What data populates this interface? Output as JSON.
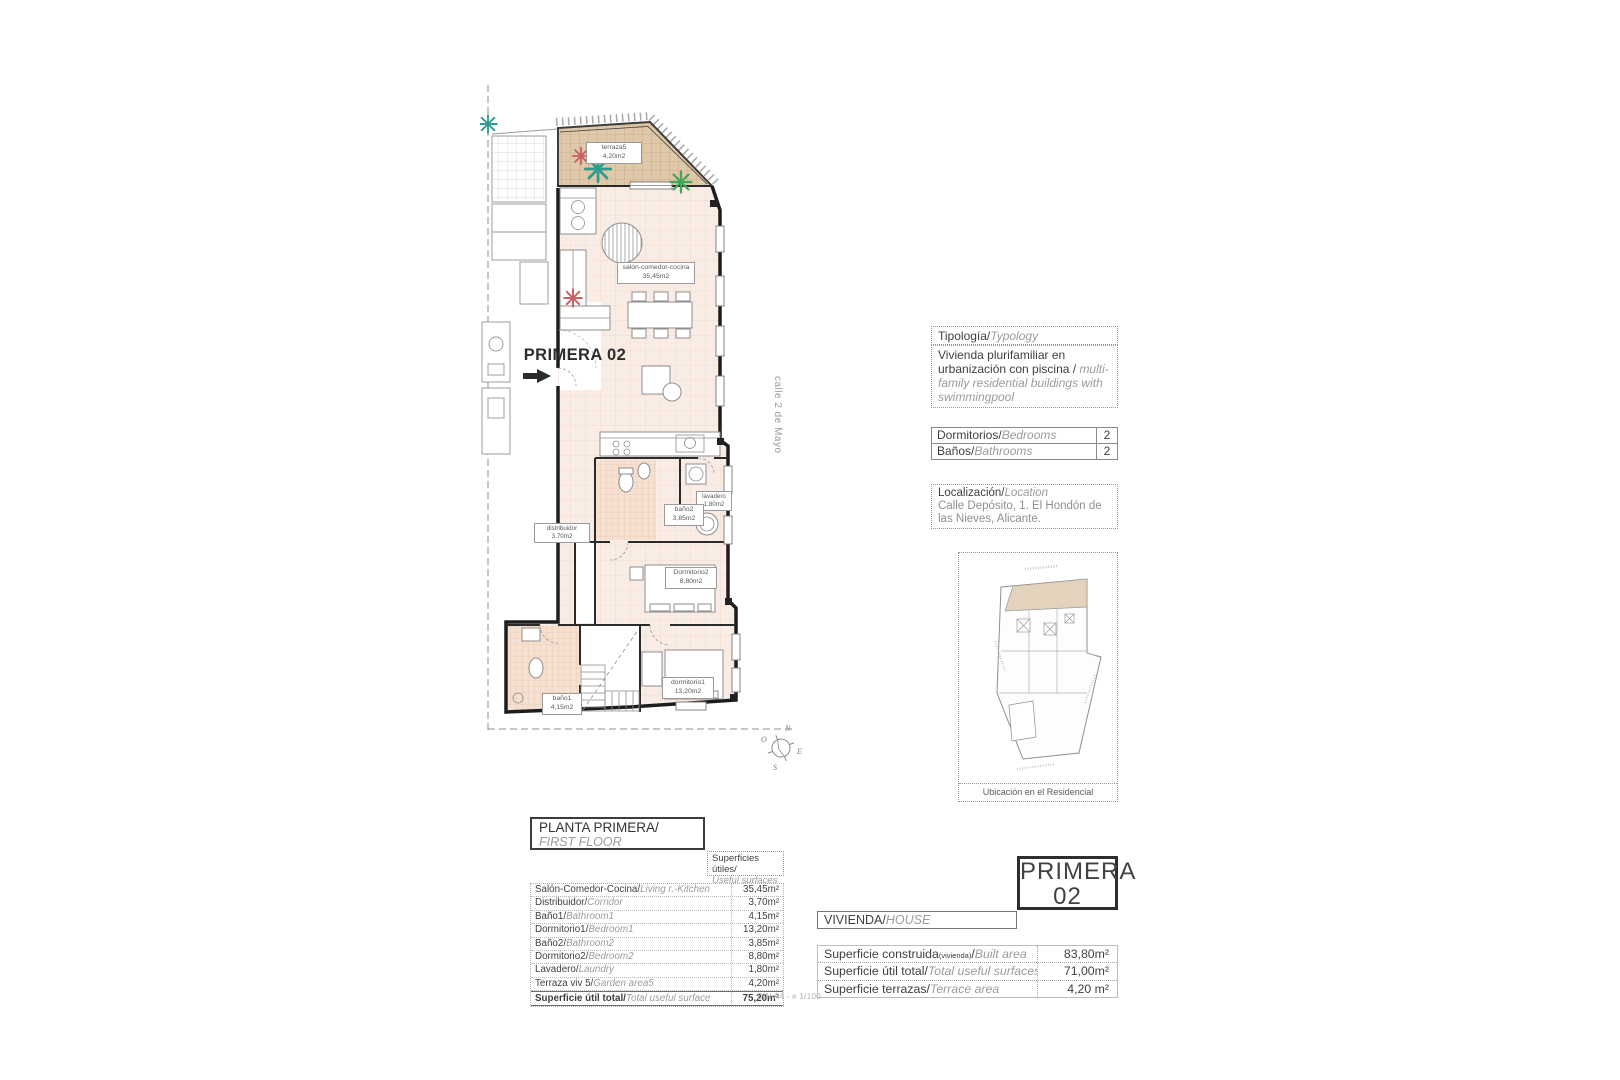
{
  "colors": {
    "floor_fill": "#f9ece4",
    "terrace_fill": "#e0c8ab",
    "bath_tile": "#f6e0d1",
    "wall": "#1d1d1d",
    "site_highlight": "#e3d2bc",
    "plant_teal": "#2f9c8e",
    "plant_green": "#44a65a",
    "plant_red": "#c95f63"
  },
  "plan": {
    "title": "PRIMERA 02",
    "street": "calle 2 de Mayo",
    "compass": {
      "n": "N",
      "e": "E",
      "s": "S",
      "o": "O"
    },
    "rooms": {
      "terraza": {
        "name": "terraza5",
        "area": "4,20m2"
      },
      "salon": {
        "name": "salón-comedor-cocina",
        "area": "35,45m2"
      },
      "lavadero": {
        "name": "lavadero",
        "area": "1,80m2"
      },
      "bano2": {
        "name": "baño2",
        "area": "3,85m2"
      },
      "distribuidor": {
        "name": "distribuidor",
        "area": "3,70m2"
      },
      "dormitorio2": {
        "name": "Dormitorio2",
        "area": "8,80m2"
      },
      "dormitorio1": {
        "name": "dormitorio1",
        "area": "13,20m2"
      },
      "bano1": {
        "name": "baño1",
        "area": "4,15m2"
      }
    }
  },
  "typology": {
    "header_es": "Tipología/",
    "header_en": "Typology",
    "body_es": "Vivienda plurifamiliar en urbanización con piscina  /",
    "body_en": "multi-family residential buildings with swimmingpool"
  },
  "counts": {
    "rows": [
      {
        "es": "Dormitorios/",
        "en": "Bedrooms",
        "value": "2"
      },
      {
        "es": "Baños/",
        "en": "Bathrooms",
        "value": "2"
      }
    ]
  },
  "location": {
    "header_es": "Localización/",
    "header_en": "Location",
    "text": "Calle Depósito, 1. El Hondón de las Nieves, Alicante."
  },
  "site": {
    "caption": "Ubicación en el Residencial"
  },
  "floor": {
    "title_es": "PLANTA PRIMERA/",
    "title_en": "FIRST FLOOR",
    "surfaces_es": "Superficies útiles/",
    "surfaces_en": "Useful surfaces",
    "rows": [
      {
        "es": "Salón-Comedor-Cocina/",
        "en": "Living r.-Kitchen",
        "value": "35,45m²"
      },
      {
        "es": "Distribuidor/",
        "en": "Corridor",
        "value": "3,70m²"
      },
      {
        "es": "Baño1/",
        "en": "Bathroom1",
        "value": "4,15m²"
      },
      {
        "es": "Dormitorio1/",
        "en": "Bedroom1",
        "value": "13,20m²"
      },
      {
        "es": "Baño2/",
        "en": "Bathroom2",
        "value": "3,85m²"
      },
      {
        "es": "Dormitorio2/",
        "en": "Bedroom2",
        "value": "8,80m²"
      },
      {
        "es": "Lavadero/",
        "en": "Laundry",
        "value": "1,80m²"
      },
      {
        "es": "Terraza viv 5/",
        "en": "Garden area5",
        "value": "4,20m²"
      }
    ],
    "total": {
      "es": "Superficie útil total/",
      "en": "Total useful surface",
      "value": "75,20m²"
    }
  },
  "unit": {
    "line1": "PRIMERA",
    "line2": "02",
    "house_es": "VIVIENDA/",
    "house_en": "HOUSE",
    "rows": [
      {
        "es": "Superficie construida",
        "note": "(vivienda)",
        "sep": "/",
        "en": "Built area",
        "value": "83,80m²"
      },
      {
        "es": "Superficie útil total/",
        "en": "Total useful surfaces",
        "value": "71,00m²"
      },
      {
        "es": "Superficie terrazas/",
        "en": "Terrace area",
        "value": "4,20 m²"
      }
    ]
  },
  "footer": "DIN A4 - e 1/100"
}
